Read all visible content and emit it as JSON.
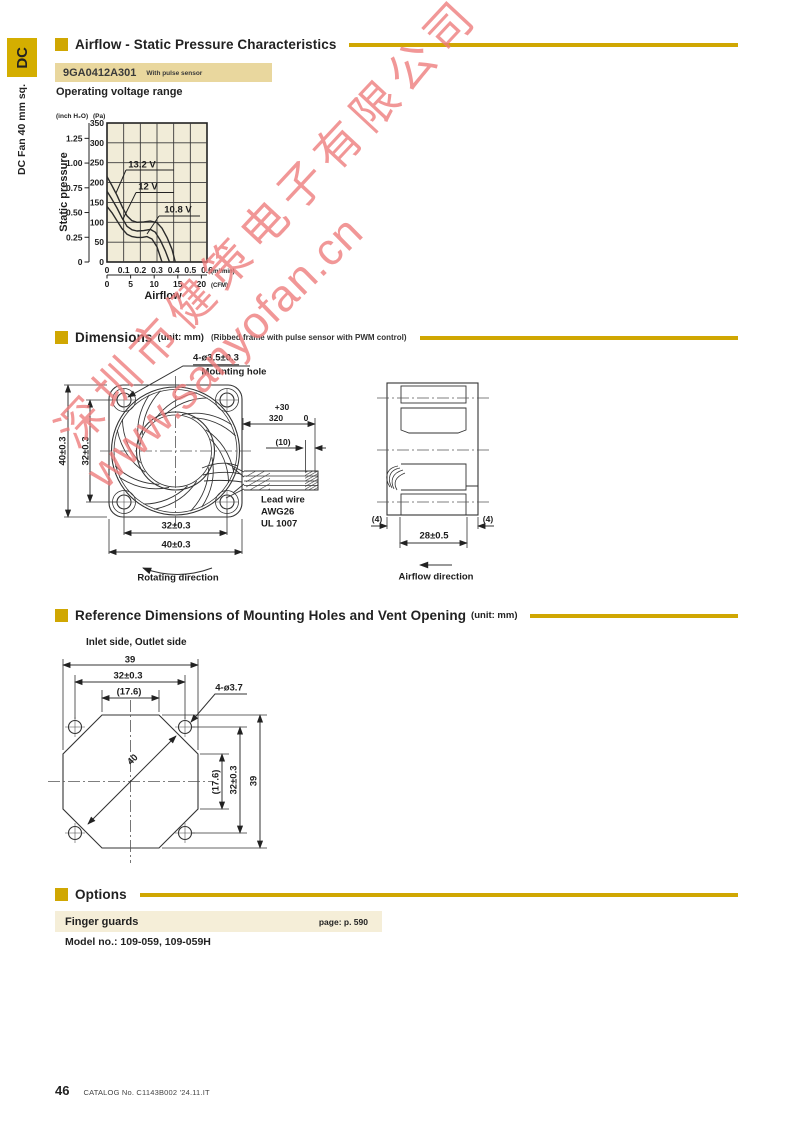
{
  "sidebar": {
    "tab": "DC",
    "label": "DC Fan 40 mm sq."
  },
  "sections": {
    "airflow": {
      "title": "Airflow - Static Pressure Characteristics"
    },
    "dimensions": {
      "title": "Dimensions",
      "unit": "(unit: mm)",
      "note": "(Ribbed frame with pulse sensor with PWM control)"
    },
    "reference": {
      "title": "Reference Dimensions of Mounting Holes and Vent Opening",
      "unit": "(unit: mm)"
    },
    "options": {
      "title": "Options"
    }
  },
  "model": {
    "number": "9GA0412A301",
    "note": "With pulse sensor"
  },
  "labels": {
    "operating_voltage": "Operating voltage range"
  },
  "chart_data": {
    "type": "line",
    "xlabel": "Airflow",
    "ylabel": "Static pressure",
    "y_axis_units": [
      "(inch H₂O)",
      "(Pa)"
    ],
    "x_axis_units": [
      "(m³/min)",
      "(CFM)"
    ],
    "ylim_pa": [
      0,
      350
    ],
    "xlim_m3min": [
      0,
      0.6
    ],
    "grid": true,
    "plot_bg": "#f1ecd8",
    "pa_tick_labels": [
      "0",
      "50",
      "100",
      "150",
      "200",
      "250",
      "300",
      "350"
    ],
    "inch_tick_labels": [
      "0",
      "0.25",
      "0.50",
      "0.75",
      "1.00",
      "1.25"
    ],
    "m3_tick_labels": [
      "0",
      "0.1",
      "0.2",
      "0.3",
      "0.4",
      "0.5",
      "0.6"
    ],
    "cfm_tick_labels": [
      "0",
      "5",
      "10",
      "15",
      "20"
    ],
    "series": [
      {
        "name": "13.2 V",
        "points_m3min_pa": [
          [
            0,
            215
          ],
          [
            0.03,
            192
          ],
          [
            0.06,
            168
          ],
          [
            0.09,
            140
          ],
          [
            0.12,
            116
          ],
          [
            0.15,
            104
          ],
          [
            0.18,
            100
          ],
          [
            0.22,
            101
          ],
          [
            0.26,
            103
          ],
          [
            0.3,
            99
          ],
          [
            0.33,
            85
          ],
          [
            0.36,
            62
          ],
          [
            0.39,
            32
          ],
          [
            0.41,
            0
          ]
        ],
        "label": {
          "tx": 142,
          "ty": 164,
          "ux1": 126,
          "ux2": 174,
          "uy": 170,
          "lx": 116,
          "ly": 193
        }
      },
      {
        "name": "12 V",
        "points_m3min_pa": [
          [
            0,
            178
          ],
          [
            0.03,
            158
          ],
          [
            0.06,
            136
          ],
          [
            0.09,
            111
          ],
          [
            0.12,
            90
          ],
          [
            0.15,
            81
          ],
          [
            0.18,
            78
          ],
          [
            0.22,
            79
          ],
          [
            0.26,
            82
          ],
          [
            0.29,
            75
          ],
          [
            0.32,
            55
          ],
          [
            0.35,
            28
          ],
          [
            0.375,
            0
          ]
        ],
        "label": {
          "tx": 148,
          "ty": 186,
          "ux1": 136,
          "ux2": 174,
          "uy": 192.5,
          "lx": 123,
          "ly": 219
        }
      },
      {
        "name": "10.8 V",
        "points_m3min_pa": [
          [
            0,
            140
          ],
          [
            0.03,
            124
          ],
          [
            0.06,
            104
          ],
          [
            0.09,
            84
          ],
          [
            0.12,
            70
          ],
          [
            0.15,
            64
          ],
          [
            0.18,
            62
          ],
          [
            0.21,
            62
          ],
          [
            0.24,
            64
          ],
          [
            0.27,
            58
          ],
          [
            0.3,
            38
          ],
          [
            0.33,
            0
          ]
        ],
        "label": {
          "tx": 178,
          "ty": 209,
          "ux1": 159,
          "ux2": 200,
          "uy": 216,
          "lx": 147,
          "ly": 234
        }
      }
    ]
  },
  "drawings": {
    "front": {
      "labels": [
        {
          "t": "4-ø3.5±0.3",
          "x": 216,
          "y": 359,
          "u": 1
        },
        {
          "t": "Mounting hole",
          "x": 234,
          "y": 372
        },
        {
          "t": "40±0.3",
          "x": 63,
          "y": 451,
          "rot": -90
        },
        {
          "t": "32±0.3",
          "x": 86,
          "y": 451,
          "rot": -90
        },
        {
          "t": "32±0.3",
          "x": 176,
          "y": 526
        },
        {
          "t": "40±0.3",
          "x": 176,
          "y": 545
        },
        {
          "t": "+30",
          "x": 282,
          "y": 407,
          "s": 8.5
        },
        {
          "t": "320",
          "x": 276,
          "y": 418,
          "s": 8.5
        },
        {
          "t": "0",
          "x": 306,
          "y": 418,
          "s": 8.5
        },
        {
          "t": "(10)",
          "x": 283,
          "y": 442,
          "s": 8.5
        },
        {
          "t": "Lead wire",
          "x": 261,
          "y": 500,
          "a": "l"
        },
        {
          "t": "AWG26",
          "x": 261,
          "y": 512,
          "a": "l"
        },
        {
          "t": "UL 1007",
          "x": 261,
          "y": 524,
          "a": "l"
        },
        {
          "t": "Rotating direction",
          "x": 178,
          "y": 578
        }
      ]
    },
    "side": {
      "labels": [
        {
          "t": "(4)",
          "x": 377,
          "y": 519,
          "s": 8.5
        },
        {
          "t": "(4)",
          "x": 488,
          "y": 519,
          "s": 8.5
        },
        {
          "t": "28±0.5",
          "x": 434,
          "y": 536
        },
        {
          "t": "Airflow direction",
          "x": 436,
          "y": 577
        }
      ]
    },
    "reference": {
      "labels": [
        {
          "t": "Inlet side, Outlet side",
          "x": 86,
          "y": 643,
          "a": "l",
          "s": 10
        },
        {
          "t": "39",
          "x": 130,
          "y": 660
        },
        {
          "t": "32±0.3",
          "x": 128,
          "y": 676
        },
        {
          "t": "(17.6)",
          "x": 129,
          "y": 692
        },
        {
          "t": "4-ø3.7",
          "x": 229,
          "y": 688
        },
        {
          "t": "40",
          "x": 133,
          "y": 760,
          "rot": -45
        },
        {
          "t": "(17.6)",
          "x": 216,
          "y": 782,
          "rot": -90
        },
        {
          "t": "32±0.3",
          "x": 234,
          "y": 780,
          "rot": -90
        },
        {
          "t": "39",
          "x": 254,
          "y": 781,
          "rot": -90
        }
      ]
    }
  },
  "options": {
    "item": "Finger guards",
    "page_ref": "page: p. 590",
    "model_line": "Model no.: 109-059, 109-059H"
  },
  "footer": {
    "page": "46",
    "catalog": "CATALOG No. C1143B002 '24.11.IT"
  },
  "watermark": {
    "line1": "深圳市健策电子有限公司",
    "line2": "www.sanyofan.cn",
    "color": "#ee7b7b"
  },
  "colors": {
    "accent": "#d0a702",
    "tab_bg": "#d4ae00",
    "model_box_bg": "#e9d79e",
    "option_box_bg": "#f5eed8",
    "chart_bg": "#f1ecd8"
  }
}
